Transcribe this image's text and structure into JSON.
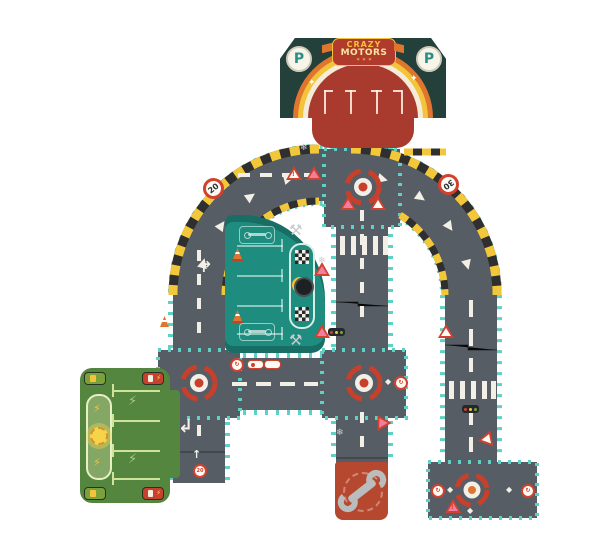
{
  "product": {
    "name": "Crazy Motors road puzzle"
  },
  "building": {
    "badge_top": "CRAZY",
    "badge_bottom": "MOTORS",
    "stars": "✶ ✶ ✶",
    "p_left": "P",
    "p_right": "P",
    "sparkle": "✦"
  },
  "signs": {
    "speed_20": "20",
    "speed_30": "30",
    "exclaim": "!",
    "mini_speed": "20",
    "roundabout_glyph": "↻"
  },
  "arrows": {
    "turn_right": "↱",
    "turn_left": "↲",
    "up": "↑",
    "diamond": "◆"
  },
  "icons": {
    "snowflake": "❄",
    "crossed_tools": "⚒",
    "lightning_bolt": "⚡"
  },
  "colors": {
    "road_gray": "#565d64",
    "edge_teal": "#5ed0c4",
    "hazard_yellow": "#f2c83a",
    "roundabout_red": "#c6402c",
    "garage_piece_teal": "#1f8c80",
    "charging_piece_green": "#55863f",
    "building_facade_green": "#24403b",
    "building_red": "#a93b2e"
  }
}
